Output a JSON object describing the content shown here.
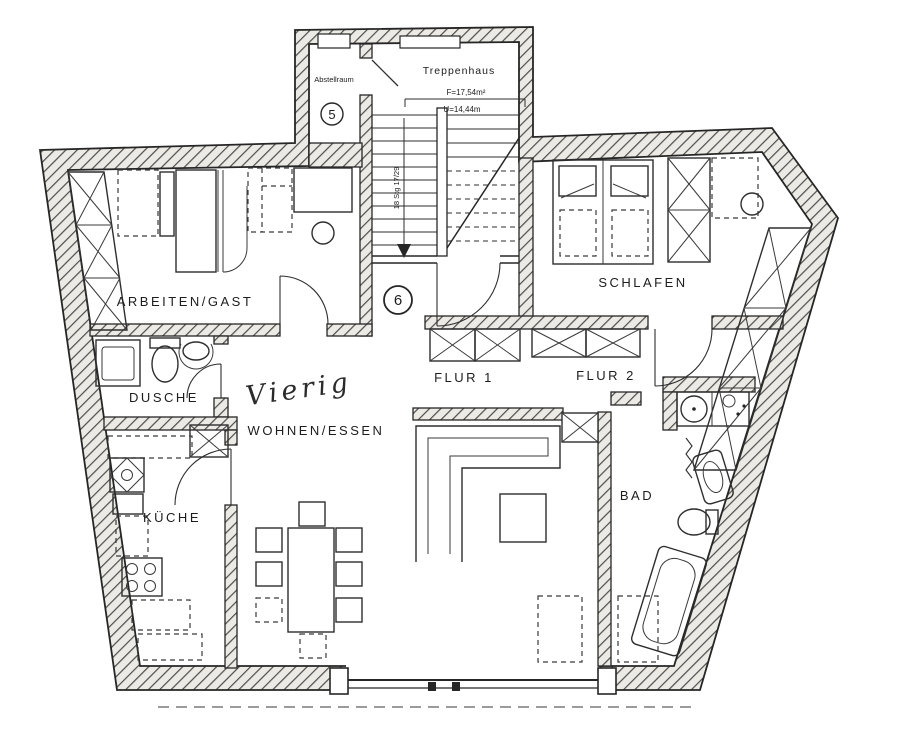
{
  "colors": {
    "ink": "#262626",
    "wall_hatch": "#4d4d4d",
    "paper": "#ffffff"
  },
  "stairwell": {
    "label": "Treppenhaus",
    "area": "F=17,54m²",
    "circumference": "U=14,44m",
    "steps_note": "18 Stg 17/29",
    "storage": {
      "label": "Abstellraum",
      "number": "5"
    }
  },
  "apartment": {
    "number": "6",
    "occupant_handwritten": "Vierig",
    "rooms": {
      "arbeiten_gast": "ARBEITEN/GAST",
      "schlafen": "SCHLAFEN",
      "dusche": "DUSCHE",
      "flur1": "FLUR 1",
      "flur2": "FLUR 2",
      "wohnen_essen": "WOHNEN/ESSEN",
      "kueche": "KÜCHE",
      "bad": "BAD"
    }
  }
}
